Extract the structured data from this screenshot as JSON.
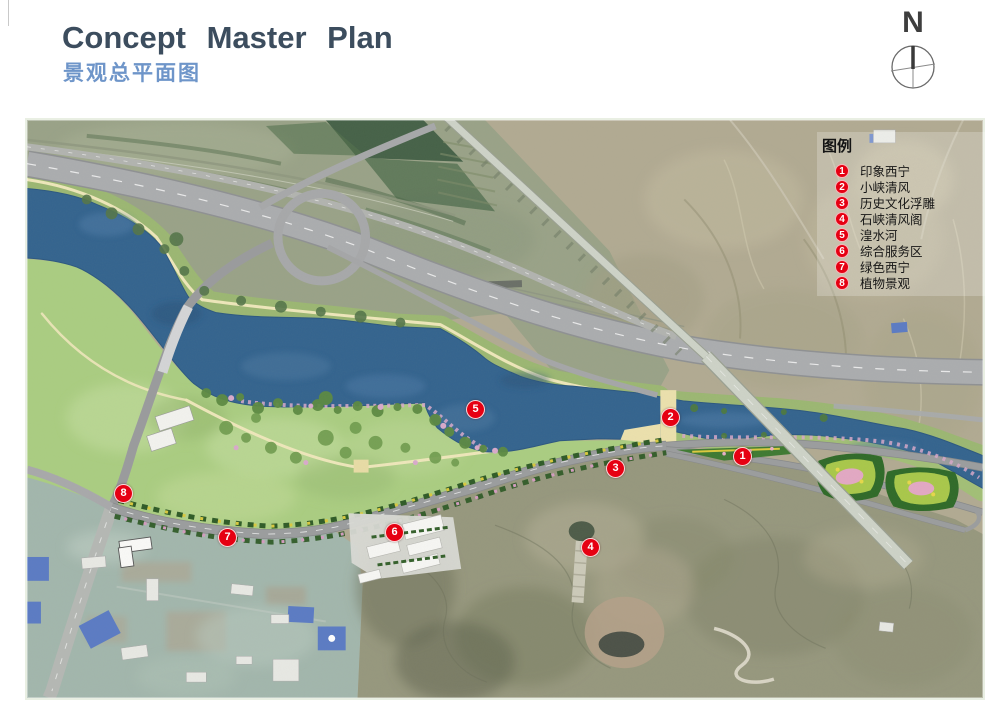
{
  "header": {
    "title": "Concept Master Plan",
    "subtitle": "景观总平面图"
  },
  "north": {
    "label": "N"
  },
  "legend": {
    "title": "图例",
    "items": [
      {
        "num": "1",
        "label": "印象西宁"
      },
      {
        "num": "2",
        "label": "小峡清风"
      },
      {
        "num": "3",
        "label": "历史文化浮雕"
      },
      {
        "num": "4",
        "label": "石峡清风阁"
      },
      {
        "num": "5",
        "label": "湟水河"
      },
      {
        "num": "6",
        "label": "综合服务区"
      },
      {
        "num": "7",
        "label": "绿色西宁"
      },
      {
        "num": "8",
        "label": "植物景观"
      }
    ]
  },
  "map": {
    "markers": [
      {
        "num": "1",
        "x": 715,
        "y": 336
      },
      {
        "num": "2",
        "x": 643,
        "y": 297
      },
      {
        "num": "3",
        "x": 588,
        "y": 348
      },
      {
        "num": "4",
        "x": 563,
        "y": 427
      },
      {
        "num": "5",
        "x": 448,
        "y": 289
      },
      {
        "num": "6",
        "x": 367,
        "y": 412
      },
      {
        "num": "7",
        "x": 200,
        "y": 417
      },
      {
        "num": "8",
        "x": 96,
        "y": 373
      }
    ],
    "colors": {
      "marker": "#e60012",
      "river": "#34648f",
      "meadow": "#abce82",
      "road": "#a8aaac",
      "footpath": "#eee6b4",
      "title_text": "#3c4d5e",
      "subtitle_text": "#6e95c9"
    }
  }
}
